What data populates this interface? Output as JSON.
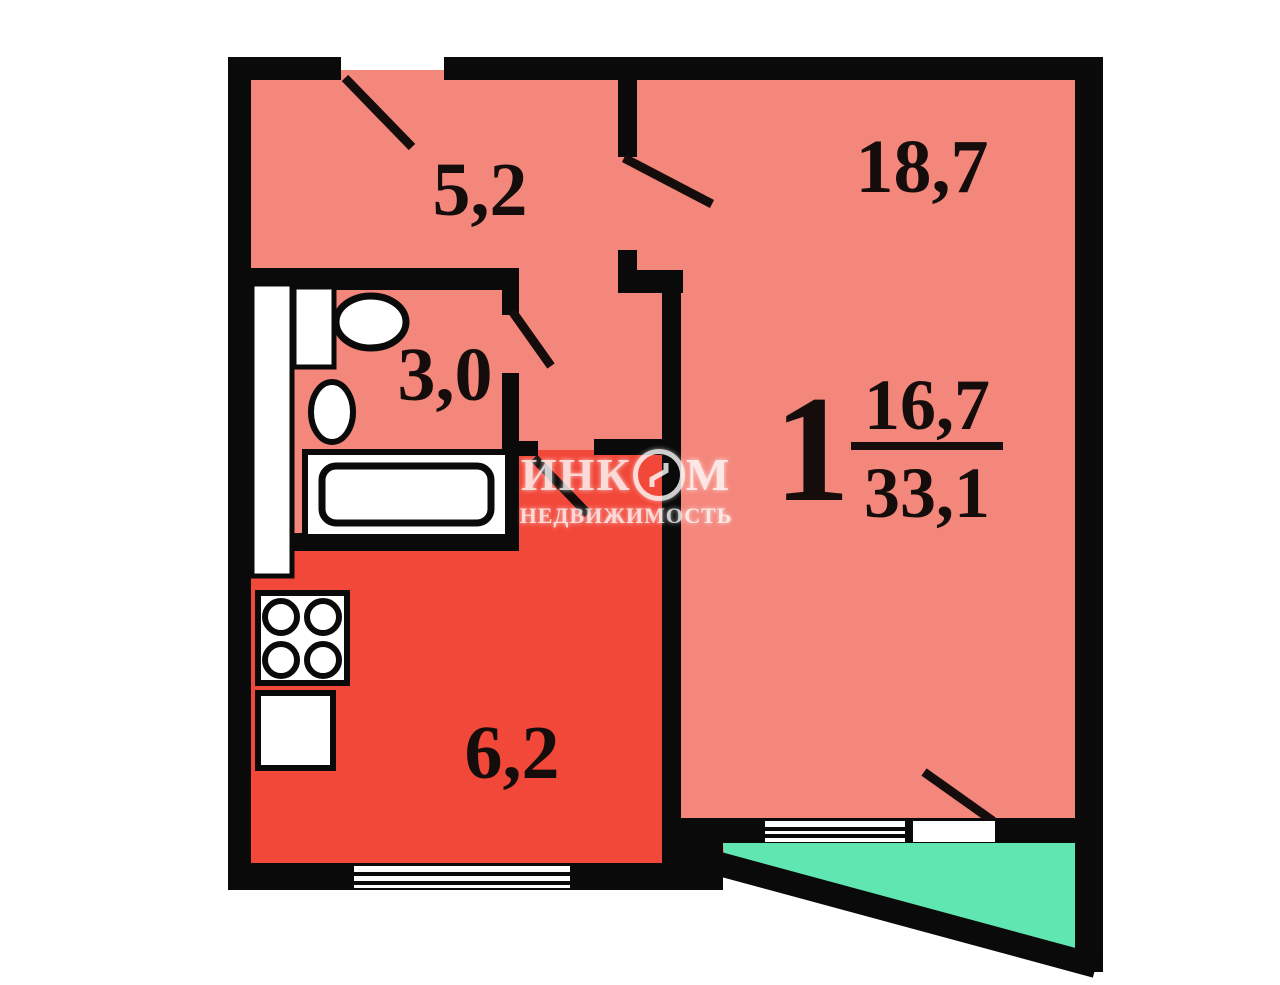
{
  "plan": {
    "rooms": [
      {
        "name": "hallway",
        "area": "5,2"
      },
      {
        "name": "living-room",
        "area": "18,7"
      },
      {
        "name": "bathroom",
        "area": "3,0"
      },
      {
        "name": "kitchen",
        "area": "6,2"
      }
    ],
    "summary": {
      "rooms": "1",
      "living_area": "16,7",
      "total_area": "33,1"
    },
    "watermark": {
      "brand_left": "ИНК",
      "brand_right": "М",
      "caption": "НЕДВИЖИМОСТЬ"
    },
    "colors": {
      "room": "#F4877C",
      "kitchen": "#F1483A",
      "balcony": "#60E7B1",
      "wall": "#0A0A0A",
      "fixture": "#FFFFFF"
    }
  }
}
